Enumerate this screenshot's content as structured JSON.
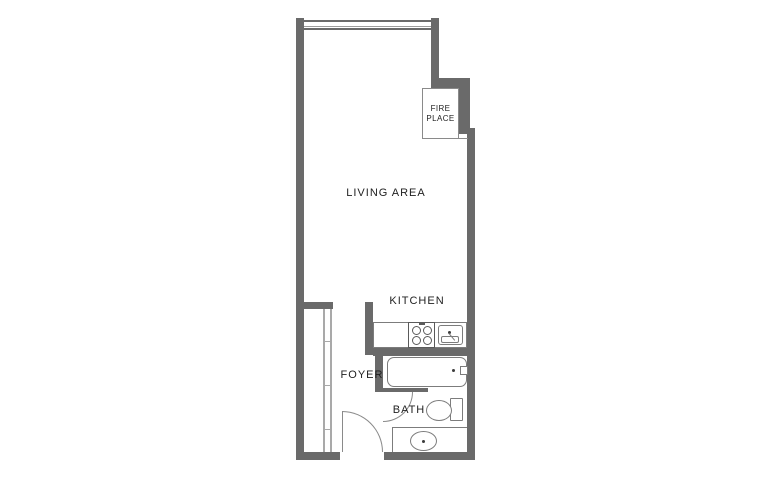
{
  "colors": {
    "background": "#ffffff",
    "wall": "#6a6a6a",
    "fixture_line": "#7c7c7c",
    "door_line": "#8a8a8a",
    "closet_line": "#a9a9a9",
    "label_text": "#1f1f1f"
  },
  "rooms": {
    "living": {
      "label": "LIVING AREA"
    },
    "kitchen": {
      "label": "KITCHEN"
    },
    "foyer": {
      "label": "FOYER"
    },
    "bath": {
      "label": "BATH"
    }
  },
  "fireplace": {
    "line1": "FIRE",
    "line2": "PLACE"
  }
}
